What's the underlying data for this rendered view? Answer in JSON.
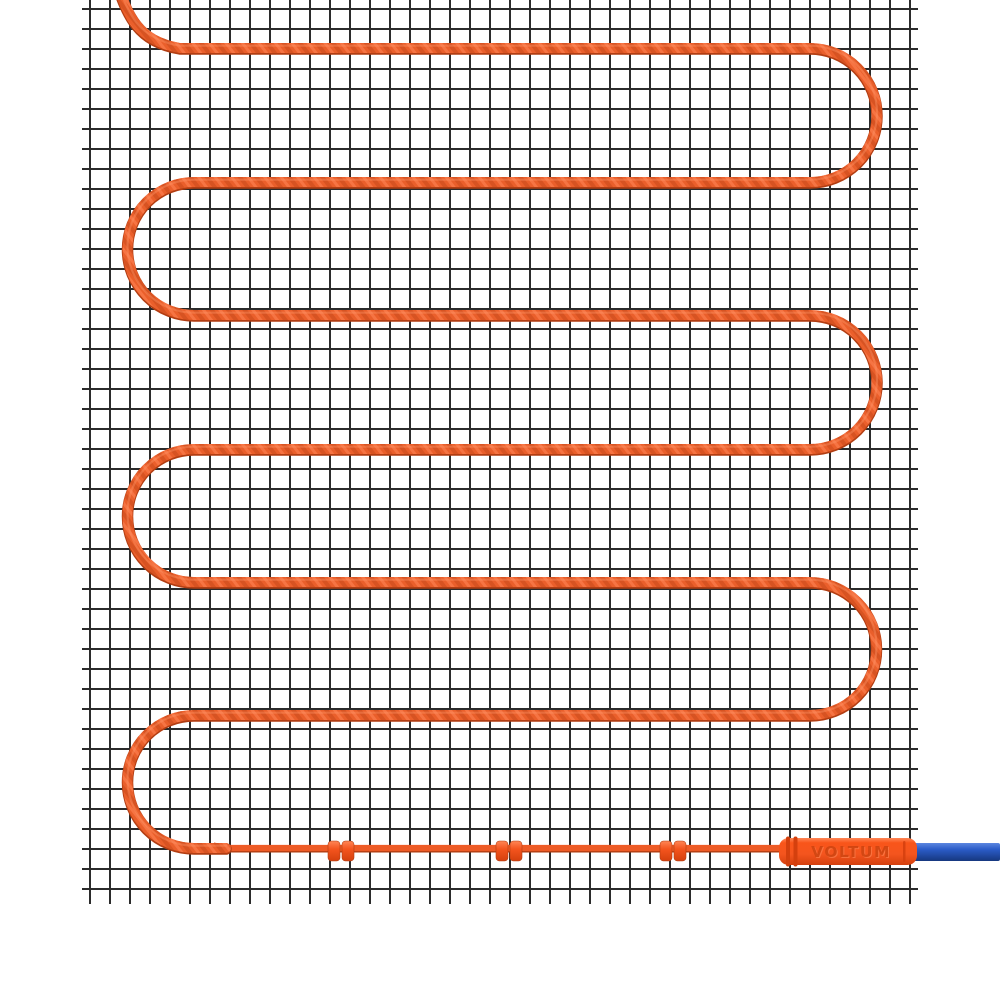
{
  "connector": {
    "label": "VOLTUM"
  },
  "colors": {
    "background": "#ffffff",
    "mesh_line": "#2b2b2b",
    "cable_orange": "#ea5f2b",
    "cable_dark": "#b23d12",
    "cable_mid_dark": "#c84a1a",
    "cable_light": "#ff8656",
    "cable_highlight": "#ff9668",
    "lead_orange": "#ee5b26",
    "clip_orange": "#f4551e",
    "connector_orange": "#f9551a",
    "connector_orange_dark": "#d4400e",
    "connector_text": "#cf4410",
    "blue_cable": "#2b5cc8",
    "blue_cable_dark": "#16377f",
    "blue_cable_light": "#5c86e0"
  },
  "mat": {
    "grid_cell_px": 20,
    "cable": {
      "entry_top_x": 112,
      "left_x": 194,
      "right_x": 810,
      "run_ys": [
        48,
        182,
        315,
        449,
        582,
        715,
        848
      ],
      "thickness": 10
    },
    "cold_lead": {
      "from_x": 222,
      "to_x": 802,
      "y": 848,
      "thickness": 6.5
    },
    "clips": {
      "pairs_x": [
        328,
        496,
        660
      ],
      "clip_width": 12,
      "clip_gap": 2,
      "y": 841,
      "height": 20
    },
    "connector": {
      "x": 779,
      "y": 838,
      "width": 138,
      "height": 27
    },
    "power_cable": {
      "x": 908,
      "y": 843,
      "width": 92,
      "height": 18
    }
  }
}
